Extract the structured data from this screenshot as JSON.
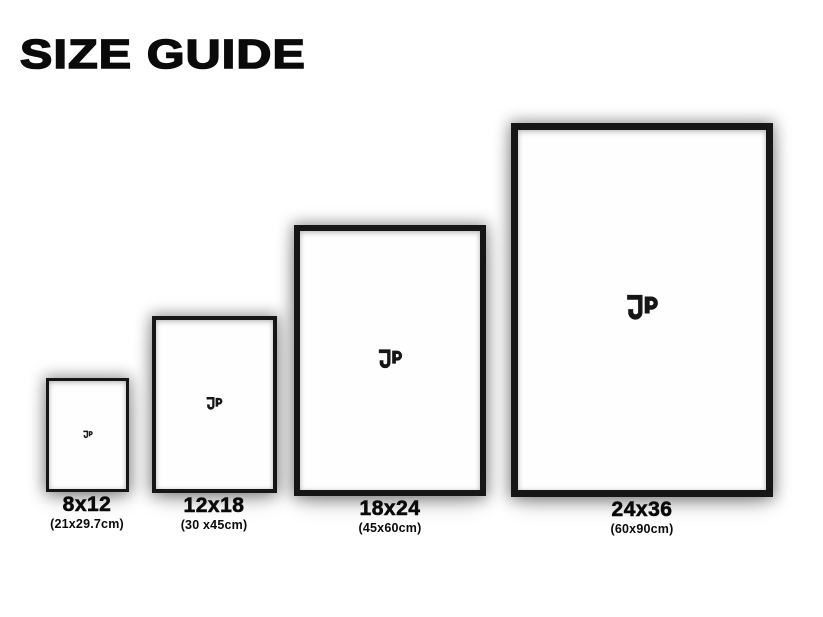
{
  "page": {
    "title": "SIZE GUIDE"
  },
  "brand": {
    "logo_icon": "jp-monogram"
  },
  "colors": {
    "frame": "#161616",
    "print": "#fefefe",
    "text": "#0a0a0a",
    "background": "#ffffff"
  },
  "frames": [
    {
      "size_label": "8x12",
      "metric_label": "(21x29.7cm)"
    },
    {
      "size_label": "12x18",
      "metric_label": "(30 x45cm)"
    },
    {
      "size_label": "18x24",
      "metric_label": "(45x60cm)"
    },
    {
      "size_label": "24x36",
      "metric_label": "(60x90cm)"
    }
  ]
}
